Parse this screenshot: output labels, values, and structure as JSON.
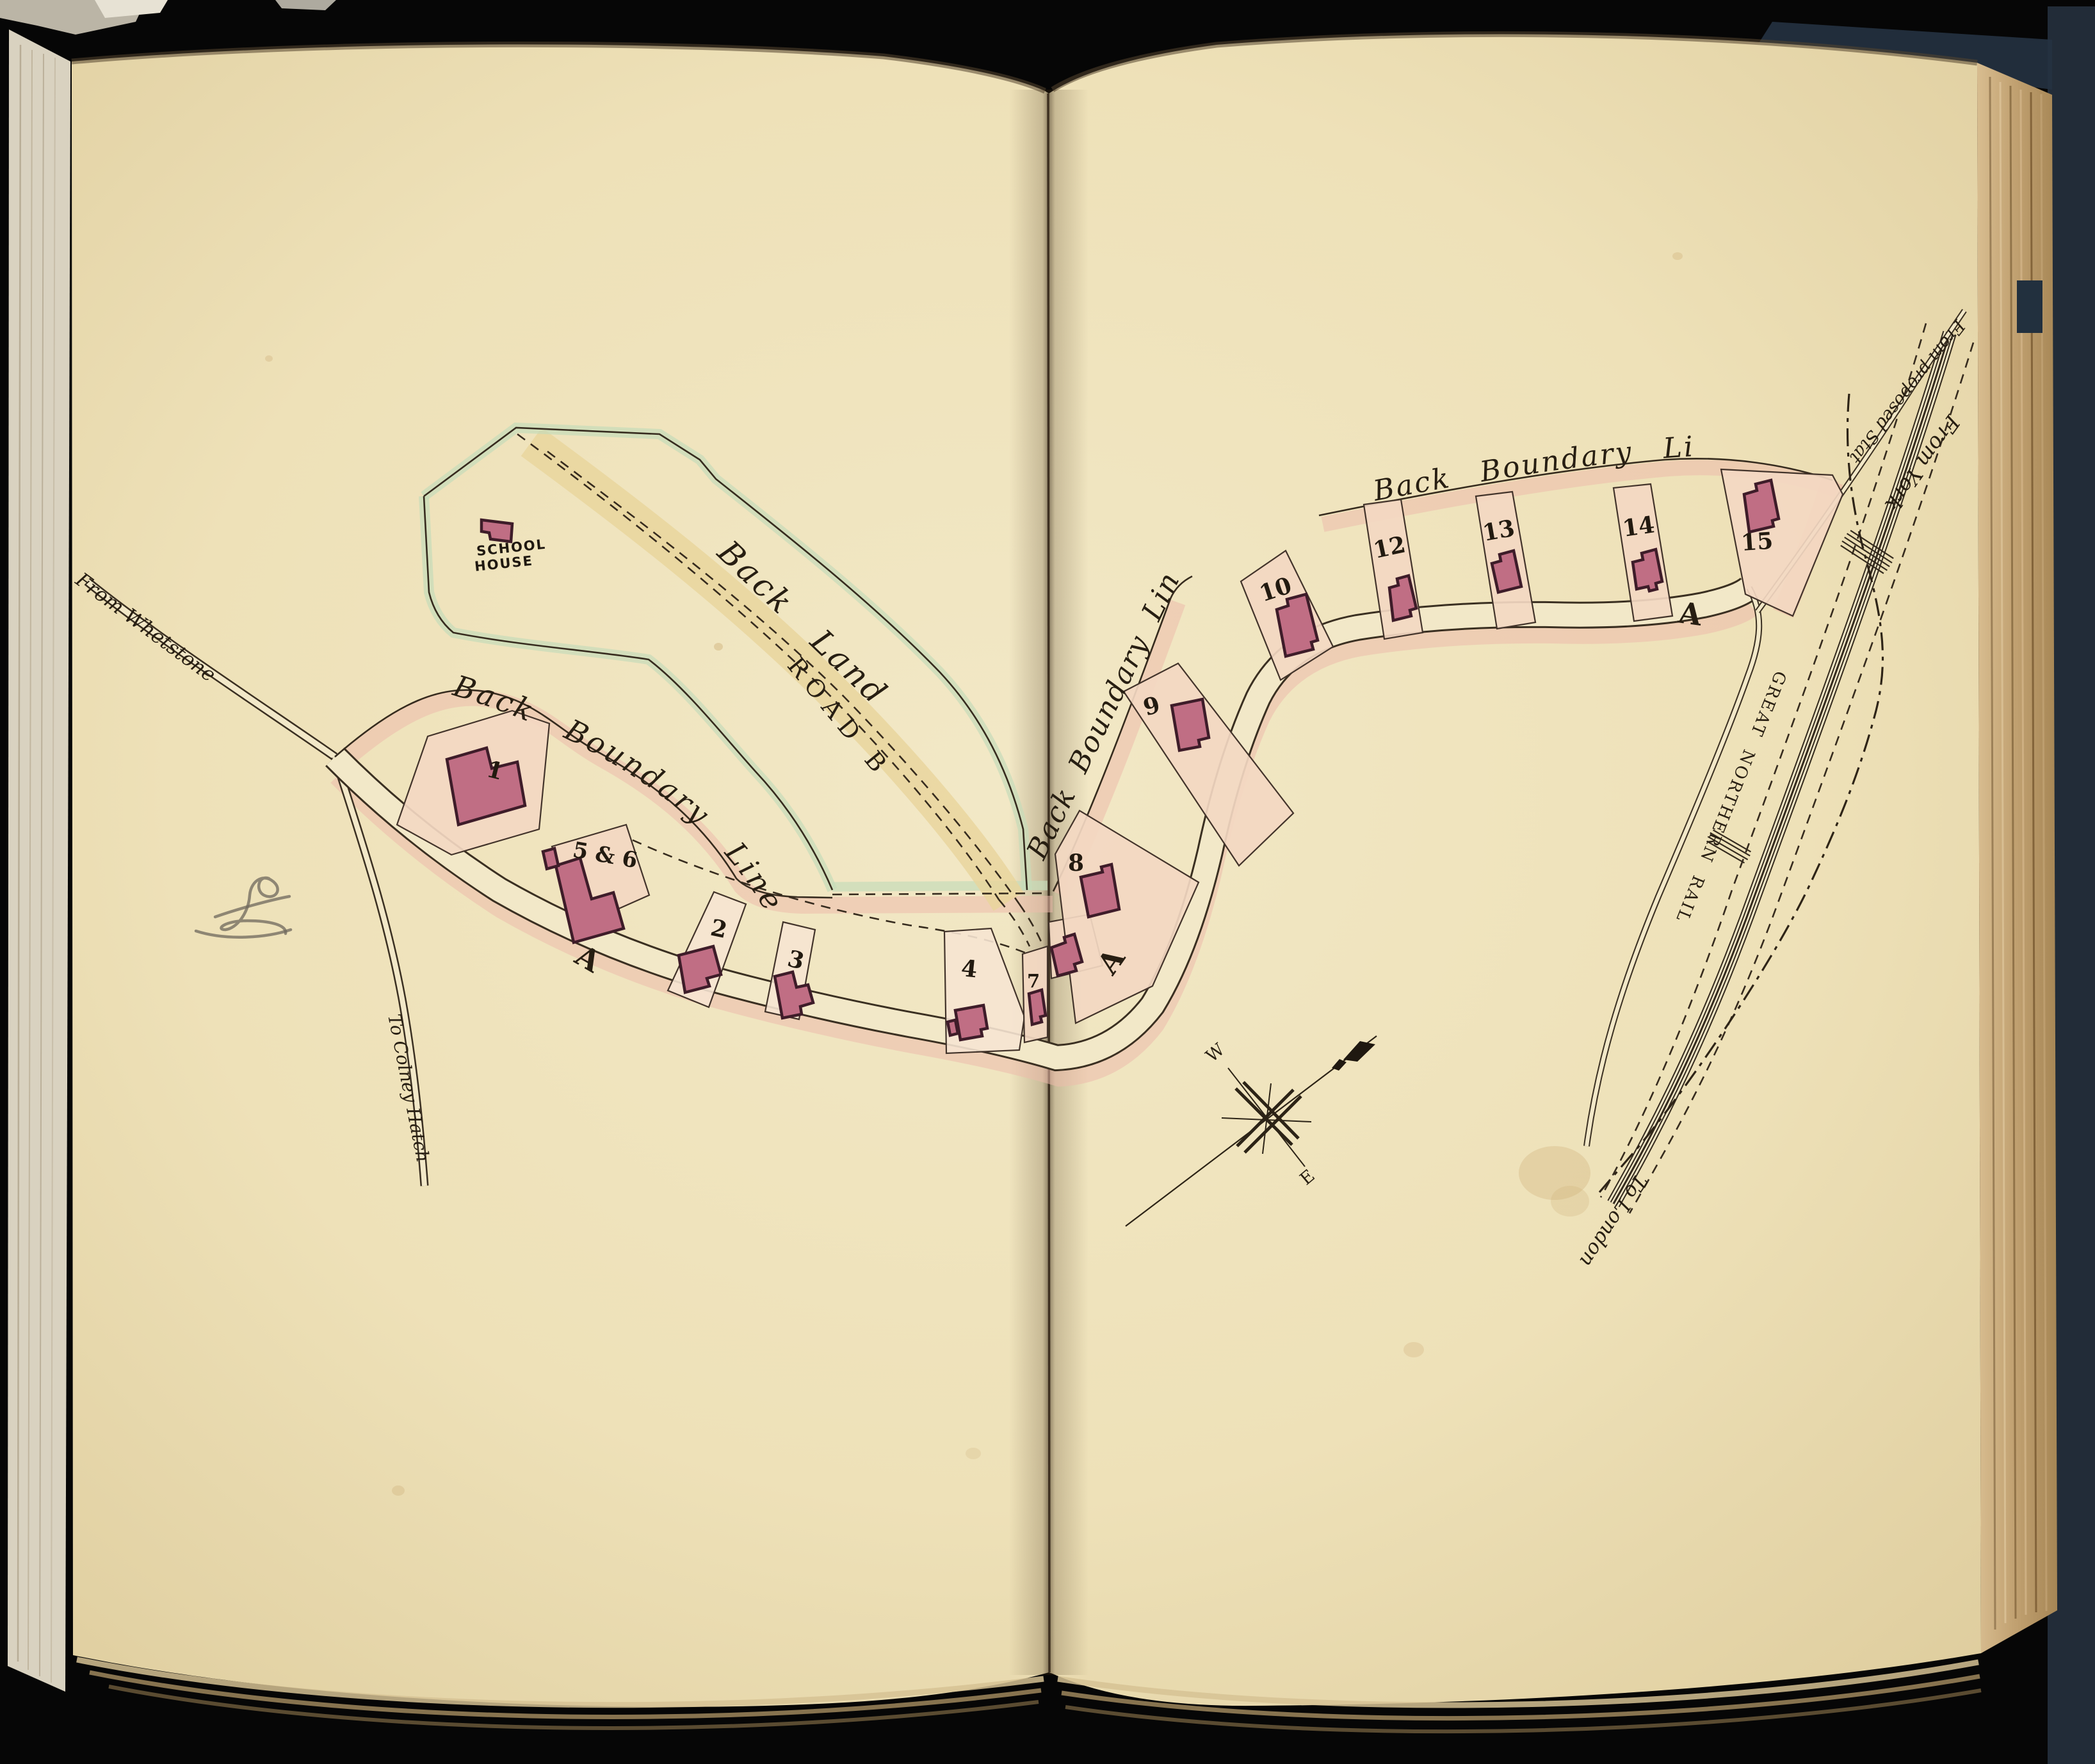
{
  "book": {
    "type": "scanned atlas spread",
    "colors": {
      "background": "#060606",
      "page": "#efe3bc",
      "page_edge": "#c7ab7e",
      "cover": "#222c38",
      "gutter_shadow": "#3a2a18"
    }
  },
  "map": {
    "labels": {
      "school_house_line1": "SCHOOL",
      "school_house_line2": "HOUSE",
      "back_land": "Back Land",
      "road_b": "ROAD B",
      "boundary_left": "Back Boundary Line",
      "boundary_mid": "Back Boundary Line",
      "boundary_top": "Back Boundary Line",
      "railway": "GREAT NORTHERN RAILWAY",
      "from_whetstone": "From Whetstone",
      "to_colney_hatch": "To Colney Hatch",
      "from_york": "From York",
      "from_proposed_station": "From proposed Station",
      "to_london": "To London",
      "road_a_left": "A",
      "road_a_mid": "A",
      "road_a_right": "A",
      "compass_w": "W",
      "compass_e": "E"
    },
    "plots": [
      {
        "label": "1"
      },
      {
        "label": "5 & 6"
      },
      {
        "label": "2"
      },
      {
        "label": "3"
      },
      {
        "label": "4"
      },
      {
        "label": "7"
      },
      {
        "label": "8"
      },
      {
        "label": "9"
      },
      {
        "label": "10"
      },
      {
        "label": "12"
      },
      {
        "label": "13"
      },
      {
        "label": "14"
      },
      {
        "label": "15"
      }
    ],
    "colors": {
      "plot_fill": "#f3d8c2",
      "building": "#c06e84",
      "boundary_wash": "#ecbcab",
      "school_boundary_wash": "#c6dcb9",
      "road_b_wash": "#e9d59b",
      "ink": "#362b1e"
    }
  }
}
